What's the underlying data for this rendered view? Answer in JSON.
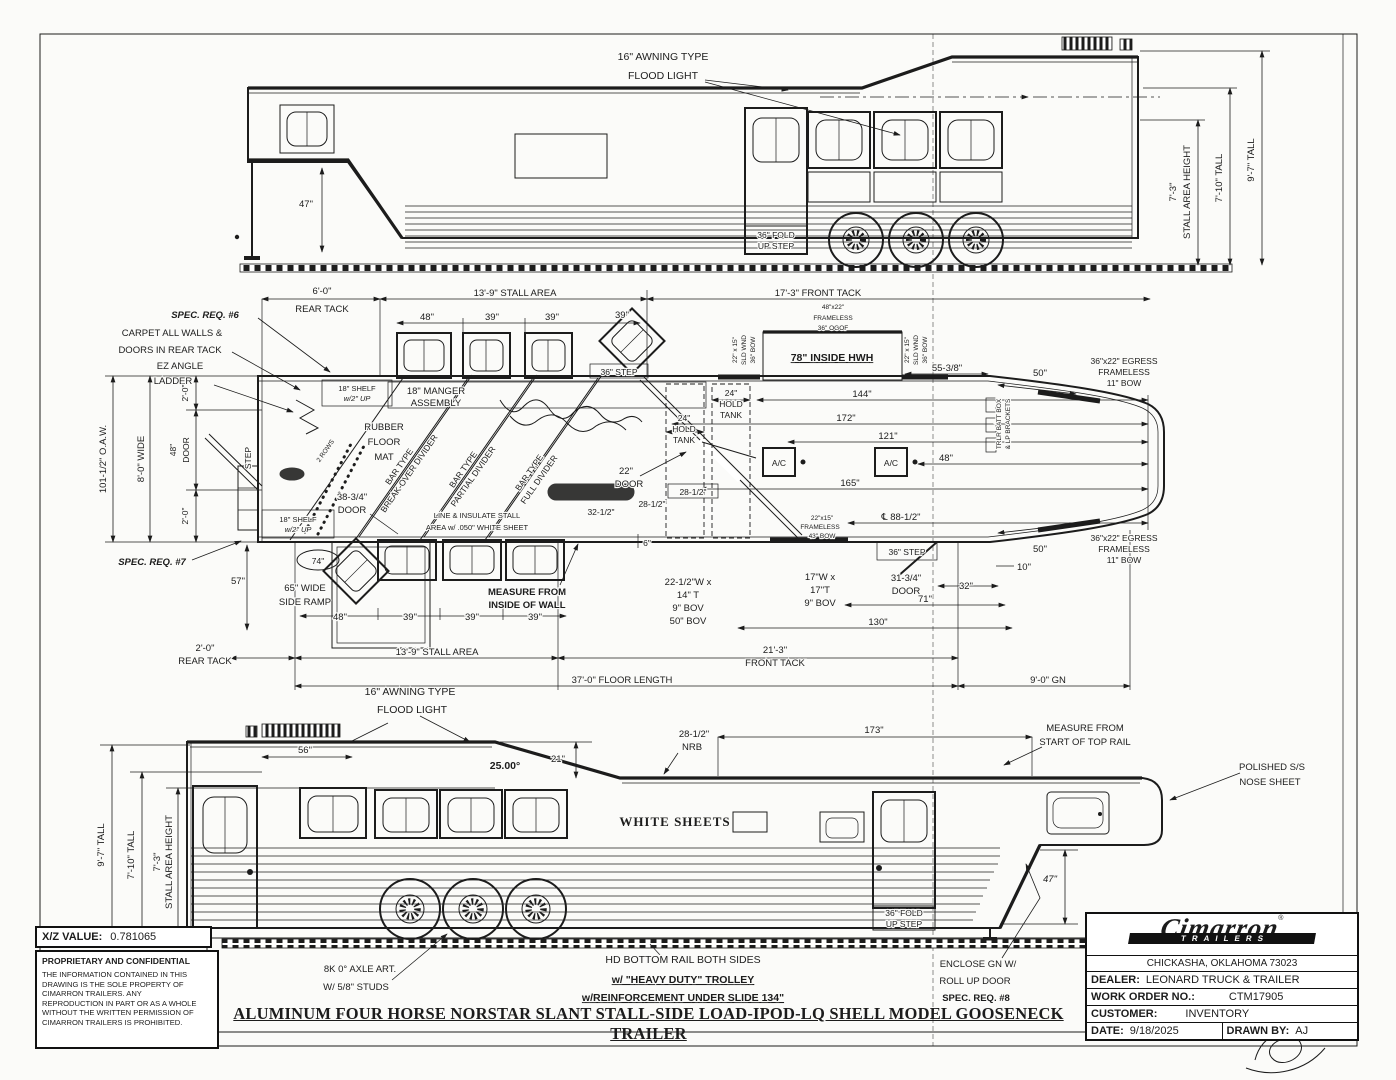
{
  "tv": {
    "awning1": "16\" AWNING TYPE",
    "awning2": "FLOOD LIGHT",
    "d47": "47\"",
    "fold1": "36\" FOLD",
    "fold2": "UP STEP",
    "h73a": "7'-3\"",
    "h73b": "STALL AREA HEIGHT",
    "h710": "7'-10\" TALL",
    "h97": "9'-7\" TALL"
  },
  "fp": {
    "spec6": "SPEC. REQ. #6",
    "carpet1": "CARPET ALL WALLS &",
    "carpet2": "DOORS IN REAR TACK",
    "ez1": "EZ ANGLE",
    "ez2": "LADDER",
    "rear_top1": "6'-0\"",
    "rear_top2": "REAR TACK",
    "stall_top": "13'-9\" STALL AREA",
    "front_top": "17'-3\" FRONT TACK",
    "w4822": "48\"x22\"",
    "frameless_t": "FRAMELESS",
    "ogof": "36\" OGOF",
    "hwh": "78\" INSIDE HWH",
    "sld1": "22\" x 15\"",
    "sld2": "SLD WND",
    "sld3": "36\" BOW",
    "sld4": "22\" x 15\"",
    "sld5": "SLD WND",
    "sld6": "36\" BOW",
    "d5538": "55-3/8\"",
    "d50t": "50\"",
    "egt1": "36\"x22\" EGRESS",
    "egt2": "FRAMELESS",
    "egt3": "11\" BOW",
    "w48t": "48\"",
    "w39t1": "39\"",
    "w39t2": "39\"",
    "w39t3": "39\"",
    "step36t": "36\" STEP",
    "oaw": "101-1/2\" O.A.W.",
    "wide8": "8'-0\" WIDE",
    "d20a": "2'-0\"",
    "door48a": "48\"",
    "door48b": "DOOR",
    "d20b": "2'-0\"",
    "stepv": "STEP",
    "shelf1a": "18\" SHELF",
    "shelf1b": "w/2\" UP",
    "shelf2a": "18\" SHELF",
    "shelf2b": "w/2\" UP",
    "manger1": "18\" MANGER",
    "manger2": "ASSEMBLY",
    "rub1": "RUBBER",
    "rub2": "FLOOR",
    "rub3": "MAT",
    "rows2": "2 ROWS",
    "div1a": "BAR TYPE",
    "div1b": "BREAK-OVER DIVIDER",
    "div2a": "BAR TYPE",
    "div2b": "PARTIAL DIVIDER",
    "div3a": "BAR TYPE",
    "div3b": "FULL DIVIDER",
    "line1": "LINE & INSULATE STALL",
    "line2": "AREA w/ .050\" WHITE SHEET",
    "d3834a": "38-3/4\"",
    "d3834b": "DOOR",
    "spec7": "SPEC. REQ. #7",
    "d57": "57\"",
    "d74": "74\"",
    "ramp1": "65\" WIDE",
    "ramp2": "SIDE RAMP",
    "w48b": "48\"",
    "w39b1": "39\"",
    "w39b2": "39\"",
    "w39b3": "39\"",
    "meas1": "MEASURE FROM",
    "meas2": "INSIDE OF WALL",
    "tankA1": "24\"",
    "tankA2": "HOLD",
    "tankA3": "TANK",
    "tankB1": "24\"",
    "tankB2": "HOLD",
    "tankB3": "TANK",
    "door22a": "22\"",
    "door22b": "DOOR",
    "d2812a": "28-1/2\"",
    "d2812b": "28-1/2\"",
    "d3212": "32-1/2\"",
    "d6": "6\"",
    "d144": "144\"",
    "d172": "172\"",
    "d121": "121\"",
    "d48x": "48\"",
    "ac1": "A/C",
    "ac2": "A/C",
    "d165": "165\"",
    "cl": "℄ 88-1/2\"",
    "w2215a": "22\"x15\"",
    "w2215b": "FRAMELESS",
    "w2215c": "43\" BOW",
    "step36b": "36\" STEP",
    "d3134a": "31-3/4\"",
    "d3134b": "DOOR",
    "d32": "32\"",
    "d71": "71\"",
    "d130": "130\"",
    "bov1a": "22-1/2\"W x",
    "bov1b": "14\" T",
    "bov1c": "9\" BOV",
    "bov1d": "50\" BOV",
    "bov2a": "17\"W x",
    "bov2b": "17\"T",
    "bov2c": "9\" BOV",
    "d10r": "10\"",
    "d50b": "50\"",
    "egb1": "36\"x22\" EGRESS",
    "egb2": "FRAMELESS",
    "egb3": "11\" BOW",
    "batt1": "TRLR BATT BOX",
    "batt2": "& LP BRACKETS",
    "rear_bot1": "2'-0\"",
    "rear_bot2": "REAR TACK",
    "stall_bot": "13'-9\" STALL AREA",
    "front_bot1": "21'-3\"",
    "front_bot2": "FRONT TACK",
    "floorlen": "37'-0\" FLOOR LENGTH",
    "gn": "9'-0\" GN"
  },
  "bv": {
    "awning1": "16\" AWNING TYPE",
    "awning2": "FLOOD LIGHT",
    "d56": "56\"",
    "d21": "21\"",
    "angle": "25.00°",
    "nrb1": "28-1/2\"",
    "nrb2": "NRB",
    "d173": "173\"",
    "meas1": "MEASURE FROM",
    "meas2": "START OF TOP RAIL",
    "nose1": "POLISHED S/S",
    "nose2": "NOSE SHEET",
    "white": "WHITE SHEETS",
    "h97": "9'-7\" TALL",
    "h710": "7'-10\" TALL",
    "h73a": "7'-3\"",
    "h73b": "STALL AREA HEIGHT",
    "fold1": "36\" FOLD",
    "fold2": "UP STEP",
    "d47": "47\"",
    "axle1": "8K 0° AXLE ART.",
    "axle2": "W/ 5/8\" STUDS",
    "enc1": "ENCLOSE GN W/",
    "enc2": "ROLL UP DOOR",
    "enc3": "SPEC. REQ. #8"
  },
  "nt": {
    "hd": "HD BOTTOM RAIL BOTH SIDES",
    "trolley": "w/ \"HEAVY DUTY\" TROLLEY",
    "reinf": "w/REINFORCEMENT UNDER SLIDE 134\"",
    "title": "ALUMINUM FOUR HORSE NORSTAR SLANT STALL-SIDE LOAD-IPOD-LQ SHELL MODEL GOOSENECK TRAILER"
  },
  "xz": {
    "label": "X/Z VALUE:",
    "value": "0.781065"
  },
  "pp": {
    "heading": "PROPRIETARY AND CONFIDENTIAL",
    "l1": "THE INFORMATION CONTAINED IN THIS",
    "l2": "DRAWING IS THE SOLE PROPERTY OF",
    "l3": "CIMARRON TRAILERS.  ANY",
    "l4": "REPRODUCTION IN PART OR AS A WHOLE",
    "l5": "WITHOUT THE WRITTEN PERMISSION OF",
    "l6": "CIMARRON TRAILERS IS PROHIBITED."
  },
  "tb": {
    "brand": "Cimarron",
    "reg": "®",
    "sub": "TRAILERS",
    "city": "CHICKASHA, OKLAHOMA 73023",
    "dealer_label": "DEALER:",
    "dealer": "LEONARD TRUCK & TRAILER",
    "wo_label": "WORK ORDER NO.:",
    "wo": "CTM17905",
    "cust_label": "CUSTOMER:",
    "cust": "INVENTORY",
    "date_label": "DATE:",
    "date": "9/18/2025",
    "drawn_label": "DRAWN BY:",
    "drawn": "AJ"
  }
}
